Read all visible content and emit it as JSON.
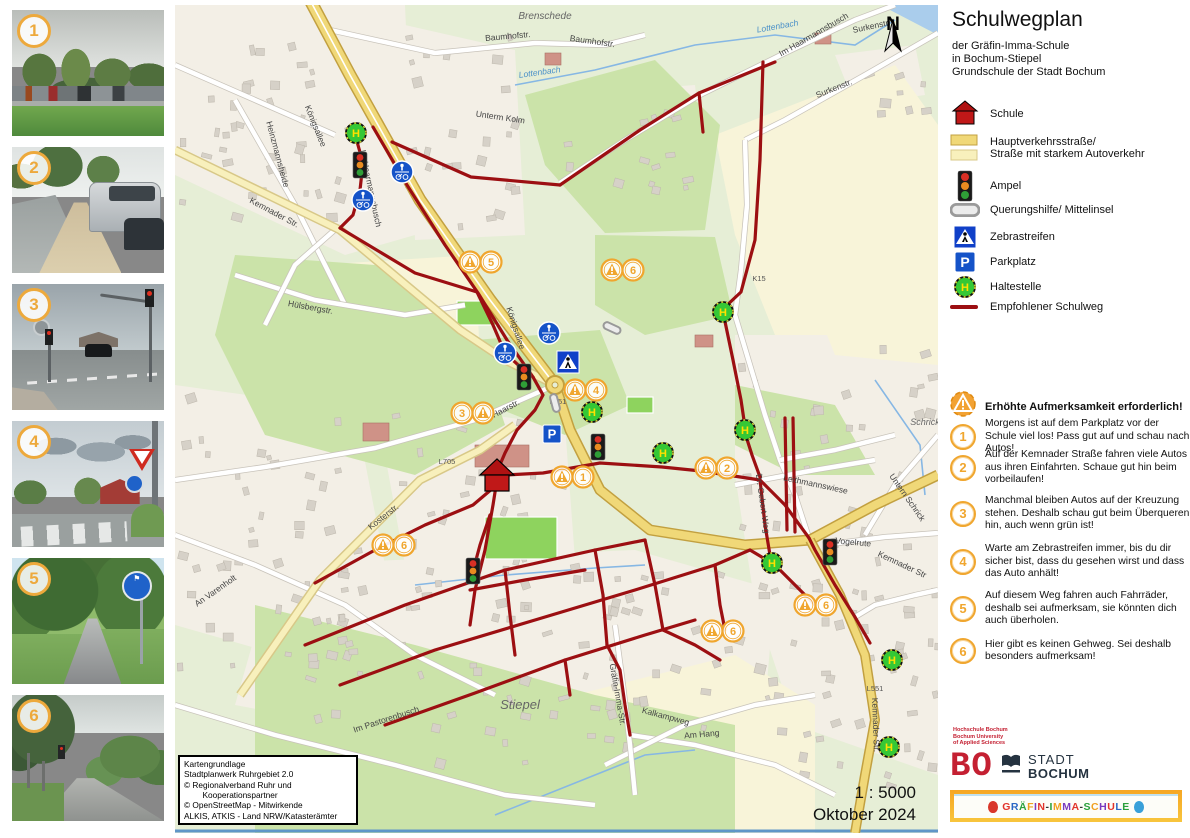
{
  "panel": {
    "title": "Schulwegplan",
    "subtitle": [
      "der Gräfin-Imma-Schule",
      "in Bochum-Stiepel",
      "Grundschule der Stadt Bochum"
    ],
    "legend": [
      {
        "icon": "school-icon",
        "label": "Schule"
      },
      {
        "icon": "major-road-swatch",
        "label": "Hauptverkehrsstraße/",
        "label2": "Straße mit starkem Autoverkehr"
      },
      {
        "icon": "traffic-light-icon",
        "label": "Ampel"
      },
      {
        "icon": "crossing-aid-icon",
        "label": "Querungshilfe/ Mittelinsel"
      },
      {
        "icon": "zebra-crossing-icon",
        "label": "Zebrastreifen"
      },
      {
        "icon": "parking-icon",
        "label": "Parkplatz"
      },
      {
        "icon": "bus-stop-icon",
        "label": "Haltestelle"
      },
      {
        "icon": "route-line-icon",
        "label": "Empfohlener Schulweg"
      }
    ],
    "warnings": {
      "header": "Erhöhte Aufmerksamkeit erforderlich!",
      "items": [
        {
          "n": "1",
          "text": "Morgens ist auf dem Parkplatz vor der Schule viel los! Pass gut auf und schau nach Autos!"
        },
        {
          "n": "2",
          "text": "Auf der Kemnader Straße fahren viele Autos aus ihren Einfahrten. Schaue gut hin beim vorbeilaufen!"
        },
        {
          "n": "3",
          "text": "Manchmal bleiben Autos auf der Kreuzung stehen. Deshalb schau gut beim Überqueren hin, auch wenn grün ist!"
        },
        {
          "n": "4",
          "text": "Warte am Zebrastreifen immer, bis du dir sicher bist, dass du gesehen wirst und dass das Auto anhält!"
        },
        {
          "n": "5",
          "text": "Auf diesem Weg fahren auch Fahrräder, deshalb sei aufmerksam, sie könnten dich auch überholen."
        },
        {
          "n": "6",
          "text": "Hier gibt es keinen Gehweg. Sei deshalb besonders aufmerksam!"
        }
      ]
    }
  },
  "map": {
    "scale": "1 : 5000",
    "date": "Oktober 2024",
    "north": "N",
    "attribution": [
      "Kartengrundlage",
      "Stadtplanwerk Ruhrgebiet 2.0",
      "© Regionalverband Ruhr und",
      "        Kooperationspartner",
      "© OpenStreetMap - Mitwirkende",
      "ALKIS, ATKIS - Land NRW/Katasterämter"
    ],
    "labels": [
      {
        "t": "Brenschede",
        "x": 370,
        "y": 14,
        "r": 0,
        "c": "place",
        "s": 10
      },
      {
        "t": "Stiepel",
        "x": 345,
        "y": 704,
        "r": 0,
        "c": "place",
        "s": 13
      },
      {
        "t": "Schrick",
        "x": 750,
        "y": 420,
        "r": 0,
        "c": "place",
        "s": 9
      },
      {
        "t": "Baumhofstr.",
        "x": 333,
        "y": 34,
        "r": -5,
        "c": "street"
      },
      {
        "t": "Baumhofstr.",
        "x": 417,
        "y": 39,
        "r": 8,
        "c": "street"
      },
      {
        "t": "Unterm Kolm",
        "x": 325,
        "y": 115,
        "r": 8,
        "c": "street"
      },
      {
        "t": "Surkenstr.",
        "x": 697,
        "y": 24,
        "r": -12,
        "c": "street"
      },
      {
        "t": "Surkenstr.",
        "x": 660,
        "y": 86,
        "r": -22,
        "c": "street"
      },
      {
        "t": "Im Haarmannsbusch",
        "x": 640,
        "y": 32,
        "r": -30,
        "c": "street"
      },
      {
        "t": "Im Haarmannsbusch",
        "x": 193,
        "y": 184,
        "r": 78,
        "c": "street"
      },
      {
        "t": "Lottenbach",
        "x": 365,
        "y": 70,
        "r": -8,
        "c": "water"
      },
      {
        "t": "Lottenbach",
        "x": 603,
        "y": 24,
        "r": -10,
        "c": "water"
      },
      {
        "t": "Königsallee",
        "x": 138,
        "y": 122,
        "r": 68,
        "c": "street"
      },
      {
        "t": "Königsallee",
        "x": 338,
        "y": 324,
        "r": 72,
        "c": "street"
      },
      {
        "t": "Kemnader Str.",
        "x": 98,
        "y": 210,
        "r": 28,
        "c": "street"
      },
      {
        "t": "Kemnader Str",
        "x": 726,
        "y": 562,
        "r": 25,
        "c": "street"
      },
      {
        "t": "Kemnader Str.",
        "x": 698,
        "y": 720,
        "r": 88,
        "c": "street"
      },
      {
        "t": "Haarstr.",
        "x": 332,
        "y": 406,
        "r": -28,
        "c": "street"
      },
      {
        "t": "Kosterstr.",
        "x": 210,
        "y": 514,
        "r": -38,
        "c": "street"
      },
      {
        "t": "Hülsbergstr.",
        "x": 135,
        "y": 305,
        "r": 10,
        "c": "street"
      },
      {
        "t": "An Varenholt",
        "x": 42,
        "y": 588,
        "r": -35,
        "c": "street"
      },
      {
        "t": "Leithmannswiese",
        "x": 640,
        "y": 482,
        "r": 12,
        "c": "street"
      },
      {
        "t": "Vogelrute",
        "x": 678,
        "y": 540,
        "r": 5,
        "c": "street"
      },
      {
        "t": "Dr.-Gebert-Weg",
        "x": 585,
        "y": 499,
        "r": 82,
        "c": "street"
      },
      {
        "t": "Untern Schrick",
        "x": 730,
        "y": 494,
        "r": 55,
        "c": "street"
      },
      {
        "t": "Gräfin-Imma-Str.",
        "x": 440,
        "y": 690,
        "r": 80,
        "c": "street"
      },
      {
        "t": "Kalkampweg",
        "x": 490,
        "y": 714,
        "r": 15,
        "c": "street"
      },
      {
        "t": "Im Pastorenbusch",
        "x": 212,
        "y": 717,
        "r": -18,
        "c": "street"
      },
      {
        "t": "Am Hang",
        "x": 527,
        "y": 732,
        "r": -5,
        "c": "street"
      },
      {
        "t": "Heinzmannsheide",
        "x": 100,
        "y": 150,
        "r": 75,
        "c": "street"
      },
      {
        "t": "L705",
        "x": 272,
        "y": 459,
        "r": 0,
        "c": "ref"
      },
      {
        "t": "L551",
        "x": 383,
        "y": 399,
        "r": 0,
        "c": "ref"
      },
      {
        "t": "L551",
        "x": 700,
        "y": 686,
        "r": 0,
        "c": "ref"
      },
      {
        "t": "K15",
        "x": 584,
        "y": 276,
        "r": 0,
        "c": "ref"
      }
    ],
    "icons": [
      {
        "type": "haltestelle",
        "x": 181,
        "y": 128
      },
      {
        "type": "haltestelle",
        "x": 548,
        "y": 307
      },
      {
        "type": "haltestelle",
        "x": 417,
        "y": 407
      },
      {
        "type": "haltestelle",
        "x": 488,
        "y": 448
      },
      {
        "type": "haltestelle",
        "x": 570,
        "y": 425
      },
      {
        "type": "haltestelle",
        "x": 597,
        "y": 558
      },
      {
        "type": "haltestelle",
        "x": 717,
        "y": 655
      },
      {
        "type": "haltestelle",
        "x": 714,
        "y": 742
      },
      {
        "type": "ampel",
        "x": 185,
        "y": 160
      },
      {
        "type": "ampel",
        "x": 349,
        "y": 372
      },
      {
        "type": "ampel",
        "x": 423,
        "y": 442
      },
      {
        "type": "ampel",
        "x": 298,
        "y": 566
      },
      {
        "type": "ampel",
        "x": 655,
        "y": 547
      },
      {
        "type": "zebra",
        "x": 393,
        "y": 357
      },
      {
        "type": "parkplatz",
        "x": 377,
        "y": 429
      },
      {
        "type": "sharedpath",
        "x": 227,
        "y": 167
      },
      {
        "type": "sharedpath",
        "x": 188,
        "y": 195
      },
      {
        "type": "sharedpath",
        "x": 374,
        "y": 328
      },
      {
        "type": "sharedpath",
        "x": 330,
        "y": 348
      },
      {
        "type": "mittelinsel",
        "x": 437,
        "y": 323,
        "r": 25
      },
      {
        "type": "mittelinsel",
        "x": 380,
        "y": 398,
        "r": 75
      },
      {
        "type": "school",
        "x": 322,
        "y": 473
      },
      {
        "type": "warnpair",
        "n": "5",
        "x": 305,
        "y": 257,
        "order": "wn"
      },
      {
        "type": "warnpair",
        "n": "6",
        "x": 447,
        "y": 265,
        "order": "wn"
      },
      {
        "type": "warnpair",
        "n": "4",
        "x": 410,
        "y": 385,
        "order": "wn"
      },
      {
        "type": "warnpair",
        "n": "3",
        "x": 297,
        "y": 408,
        "order": "nw"
      },
      {
        "type": "warnpair",
        "n": "1",
        "x": 397,
        "y": 472,
        "order": "wn"
      },
      {
        "type": "warnpair",
        "n": "2",
        "x": 541,
        "y": 463,
        "order": "wn"
      },
      {
        "type": "warnpair",
        "n": "6",
        "x": 218,
        "y": 540,
        "order": "wn"
      },
      {
        "type": "warnpair",
        "n": "6",
        "x": 640,
        "y": 600,
        "order": "wn"
      },
      {
        "type": "warnpair",
        "n": "6",
        "x": 547,
        "y": 626,
        "order": "wn"
      }
    ]
  },
  "photos": [
    {
      "n": "1"
    },
    {
      "n": "2"
    },
    {
      "n": "3"
    },
    {
      "n": "4"
    },
    {
      "n": "5"
    },
    {
      "n": "6"
    }
  ],
  "logos": {
    "hochschule": [
      "Hochschule Bochum",
      "Bochum University",
      "of Applied Sciences"
    ],
    "bo": "BO",
    "stadt_line1": "STADT",
    "stadt_line2": "BOCHUM",
    "school_banner": "GRÄFIN-IMMA-SCHULE",
    "banner_colors": [
      "#e2342b",
      "#2b67c4",
      "#2ba03c",
      "#f0a020",
      "#7a3bbf"
    ],
    "balloon_left": "#d9372a",
    "balloon_right": "#3aa0d9"
  }
}
